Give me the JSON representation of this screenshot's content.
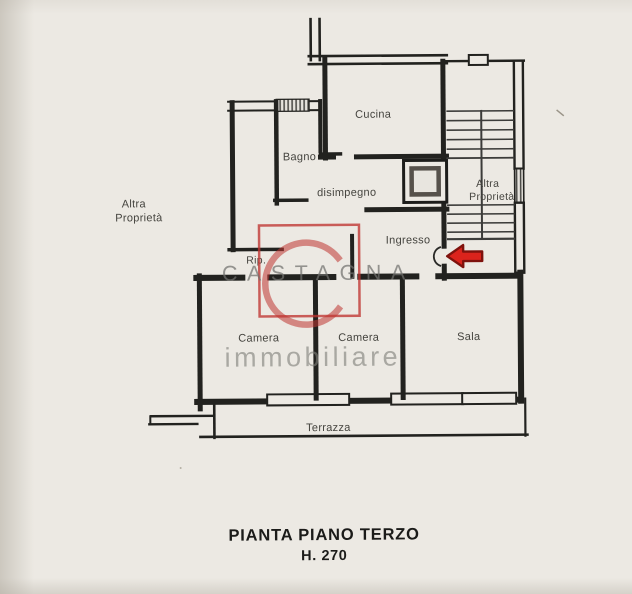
{
  "plan": {
    "labels": {
      "altra_left_1": "Altra",
      "altra_left_2": "Proprietà",
      "cucina": "Cucina",
      "bagno": "Bagno",
      "disimpegno": "disimpegno",
      "altra_stairs_1": "Altra",
      "altra_stairs_2": "Proprietà",
      "ingresso": "Ingresso",
      "rip": "Rip.",
      "camera_1": "Camera",
      "camera_2": "Camera",
      "sala": "Sala",
      "terrazza": "Terrazza"
    },
    "title_line1": "PIANTA PIANO TERZO",
    "title_line2": "H. 270"
  },
  "watermark": {
    "brand": "CASTAGNA",
    "tagline": "immobiliare"
  },
  "annotations": {
    "entrance_arrow": "red-arrow-pointing-to-entrance-door"
  },
  "colors": {
    "paper": "#ece9e3",
    "ink": "#22221f",
    "stair_ink": "#3c3c3a",
    "watermark_red": "#bf3531",
    "watermark_gray": "#8d8c88",
    "arrow_fill": "#db231c",
    "arrow_outline": "#7e120d"
  }
}
